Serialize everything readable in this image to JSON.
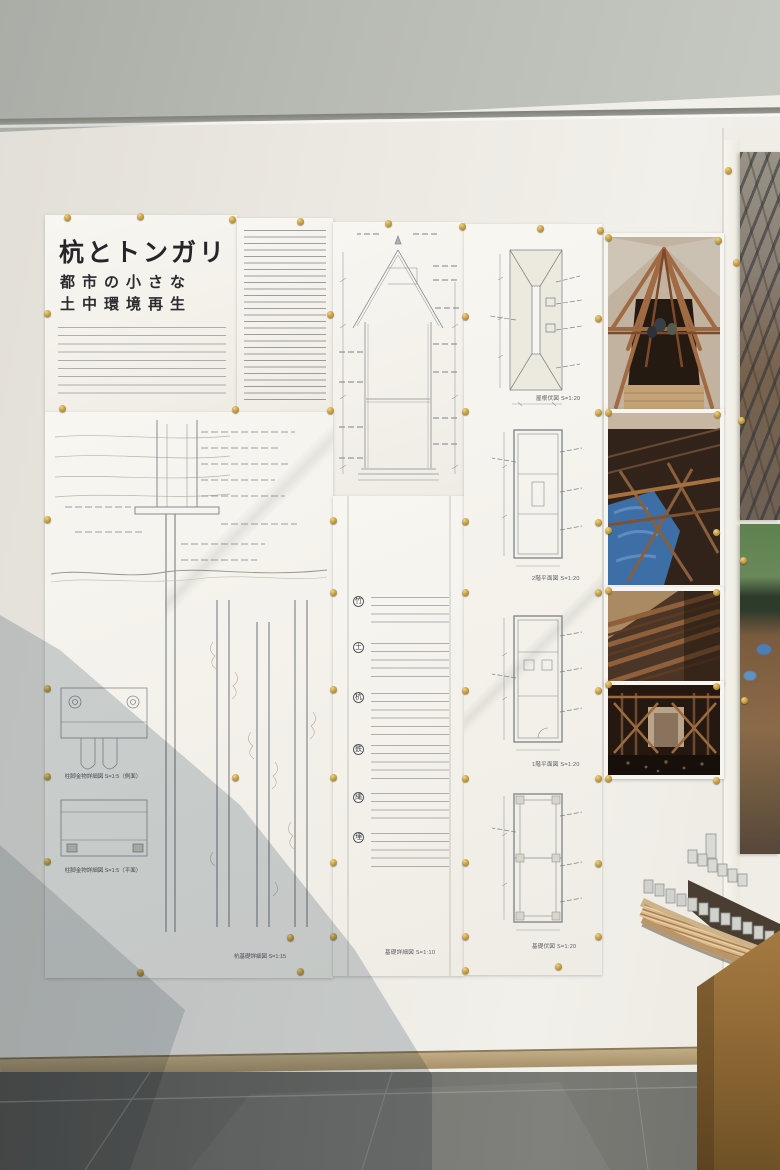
{
  "poster": {
    "title": "杭とトンガリ",
    "subtitle_line1": "都市の小さな",
    "subtitle_line2": "土中環境再生",
    "detail_caption_side": "柱脚金物詳細図 S=1:5（側面）",
    "detail_caption_plan": "柱脚金物詳細図 S=1:5（平面）",
    "pile_caption": "杭基礎詳細図 S=1:15",
    "notes_caption": "基礎詳細図 S=1:10",
    "note_markers": [
      "竹",
      "土",
      "杭",
      "鉄",
      "縄",
      "埋"
    ],
    "plans": [
      {
        "caption": "屋根伏図 S=1:20"
      },
      {
        "caption": "2階平面図 S=1:20"
      },
      {
        "caption": "1階平面図 S=1:20"
      },
      {
        "caption": "基礎伏図 S=1:20"
      }
    ]
  },
  "photos": [
    {
      "name": "roof-apex-timber-framing"
    },
    {
      "name": "interior-framing-blue-tarp"
    },
    {
      "name": "ceiling-joists-view"
    },
    {
      "name": "braced-corridor-interior"
    }
  ],
  "colors": {
    "wall": "#ebe8e1",
    "ceiling": "#b7bab2",
    "paper": "#f6f4ef",
    "ink": "#8a8e92",
    "pin_gold": "#c49a3a",
    "wood_photo": "#8a5a36",
    "tarp_blue": "#3d6ea6",
    "floor_tile": "#6e6e6a",
    "counter_plywood": "#a07a42",
    "shadow_blue": "#7a8c9a"
  },
  "pins": [
    [
      67,
      217
    ],
    [
      140,
      216
    ],
    [
      232,
      219
    ],
    [
      300,
      221
    ],
    [
      388,
      223
    ],
    [
      462,
      226
    ],
    [
      540,
      228
    ],
    [
      600,
      230
    ],
    [
      47,
      313
    ],
    [
      330,
      314
    ],
    [
      465,
      316
    ],
    [
      598,
      318
    ],
    [
      62,
      408
    ],
    [
      235,
      409
    ],
    [
      330,
      410
    ],
    [
      465,
      411
    ],
    [
      598,
      412
    ],
    [
      47,
      519
    ],
    [
      333,
      520
    ],
    [
      465,
      521
    ],
    [
      598,
      522
    ],
    [
      333,
      592
    ],
    [
      465,
      592
    ],
    [
      598,
      592
    ],
    [
      47,
      688
    ],
    [
      333,
      689
    ],
    [
      465,
      690
    ],
    [
      598,
      690
    ],
    [
      47,
      776
    ],
    [
      235,
      777
    ],
    [
      333,
      777
    ],
    [
      465,
      778
    ],
    [
      598,
      778
    ],
    [
      47,
      861
    ],
    [
      333,
      862
    ],
    [
      465,
      862
    ],
    [
      598,
      863
    ],
    [
      290,
      937
    ],
    [
      333,
      936
    ],
    [
      465,
      936
    ],
    [
      598,
      936
    ],
    [
      140,
      972
    ],
    [
      300,
      971
    ],
    [
      465,
      970
    ],
    [
      558,
      966
    ],
    [
      608,
      237
    ],
    [
      718,
      240
    ],
    [
      608,
      412
    ],
    [
      717,
      414
    ],
    [
      608,
      530
    ],
    [
      716,
      532
    ],
    [
      608,
      590
    ],
    [
      716,
      592
    ],
    [
      608,
      684
    ],
    [
      716,
      686
    ],
    [
      608,
      778
    ],
    [
      716,
      780
    ],
    [
      728,
      170
    ],
    [
      736,
      262
    ],
    [
      741,
      420
    ],
    [
      743,
      560
    ],
    [
      744,
      700
    ]
  ]
}
